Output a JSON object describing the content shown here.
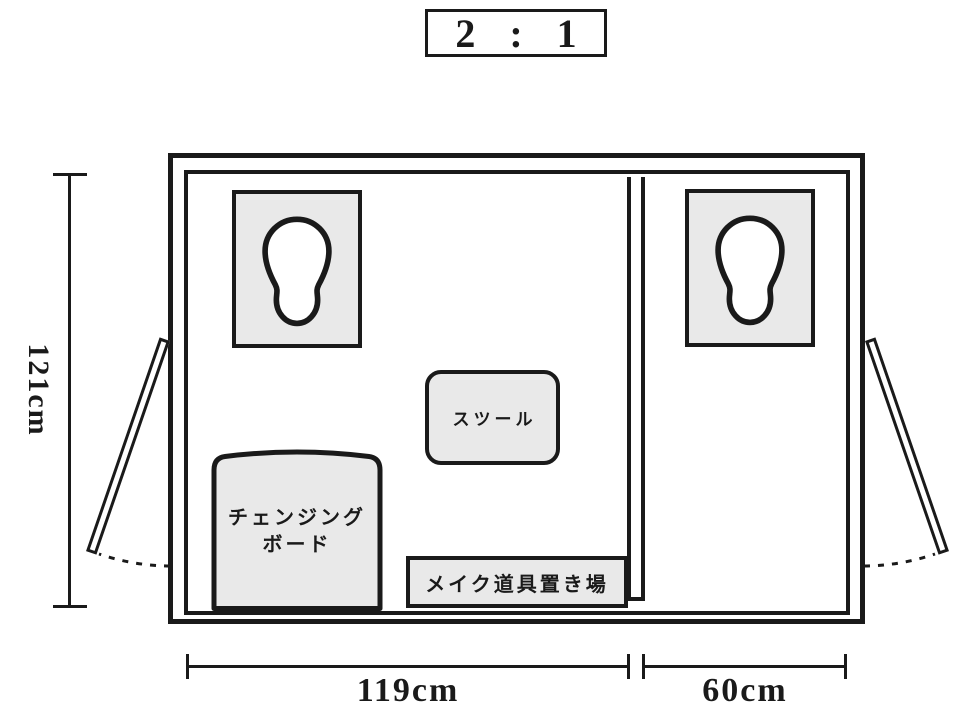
{
  "scale": {
    "label": "2 : 1"
  },
  "dimensions": {
    "height": "121cm",
    "width_main_room": "119cm",
    "width_side_room": "60cm"
  },
  "labels": {
    "stool": "スツール",
    "changing_board_line1": "チェンジング",
    "changing_board_line2": "ボード",
    "makeup_area": "メイク道具置き場"
  },
  "colors": {
    "line": "#1a1a1a",
    "furniture_fill": "#e9e9e9",
    "background": "#ffffff"
  }
}
